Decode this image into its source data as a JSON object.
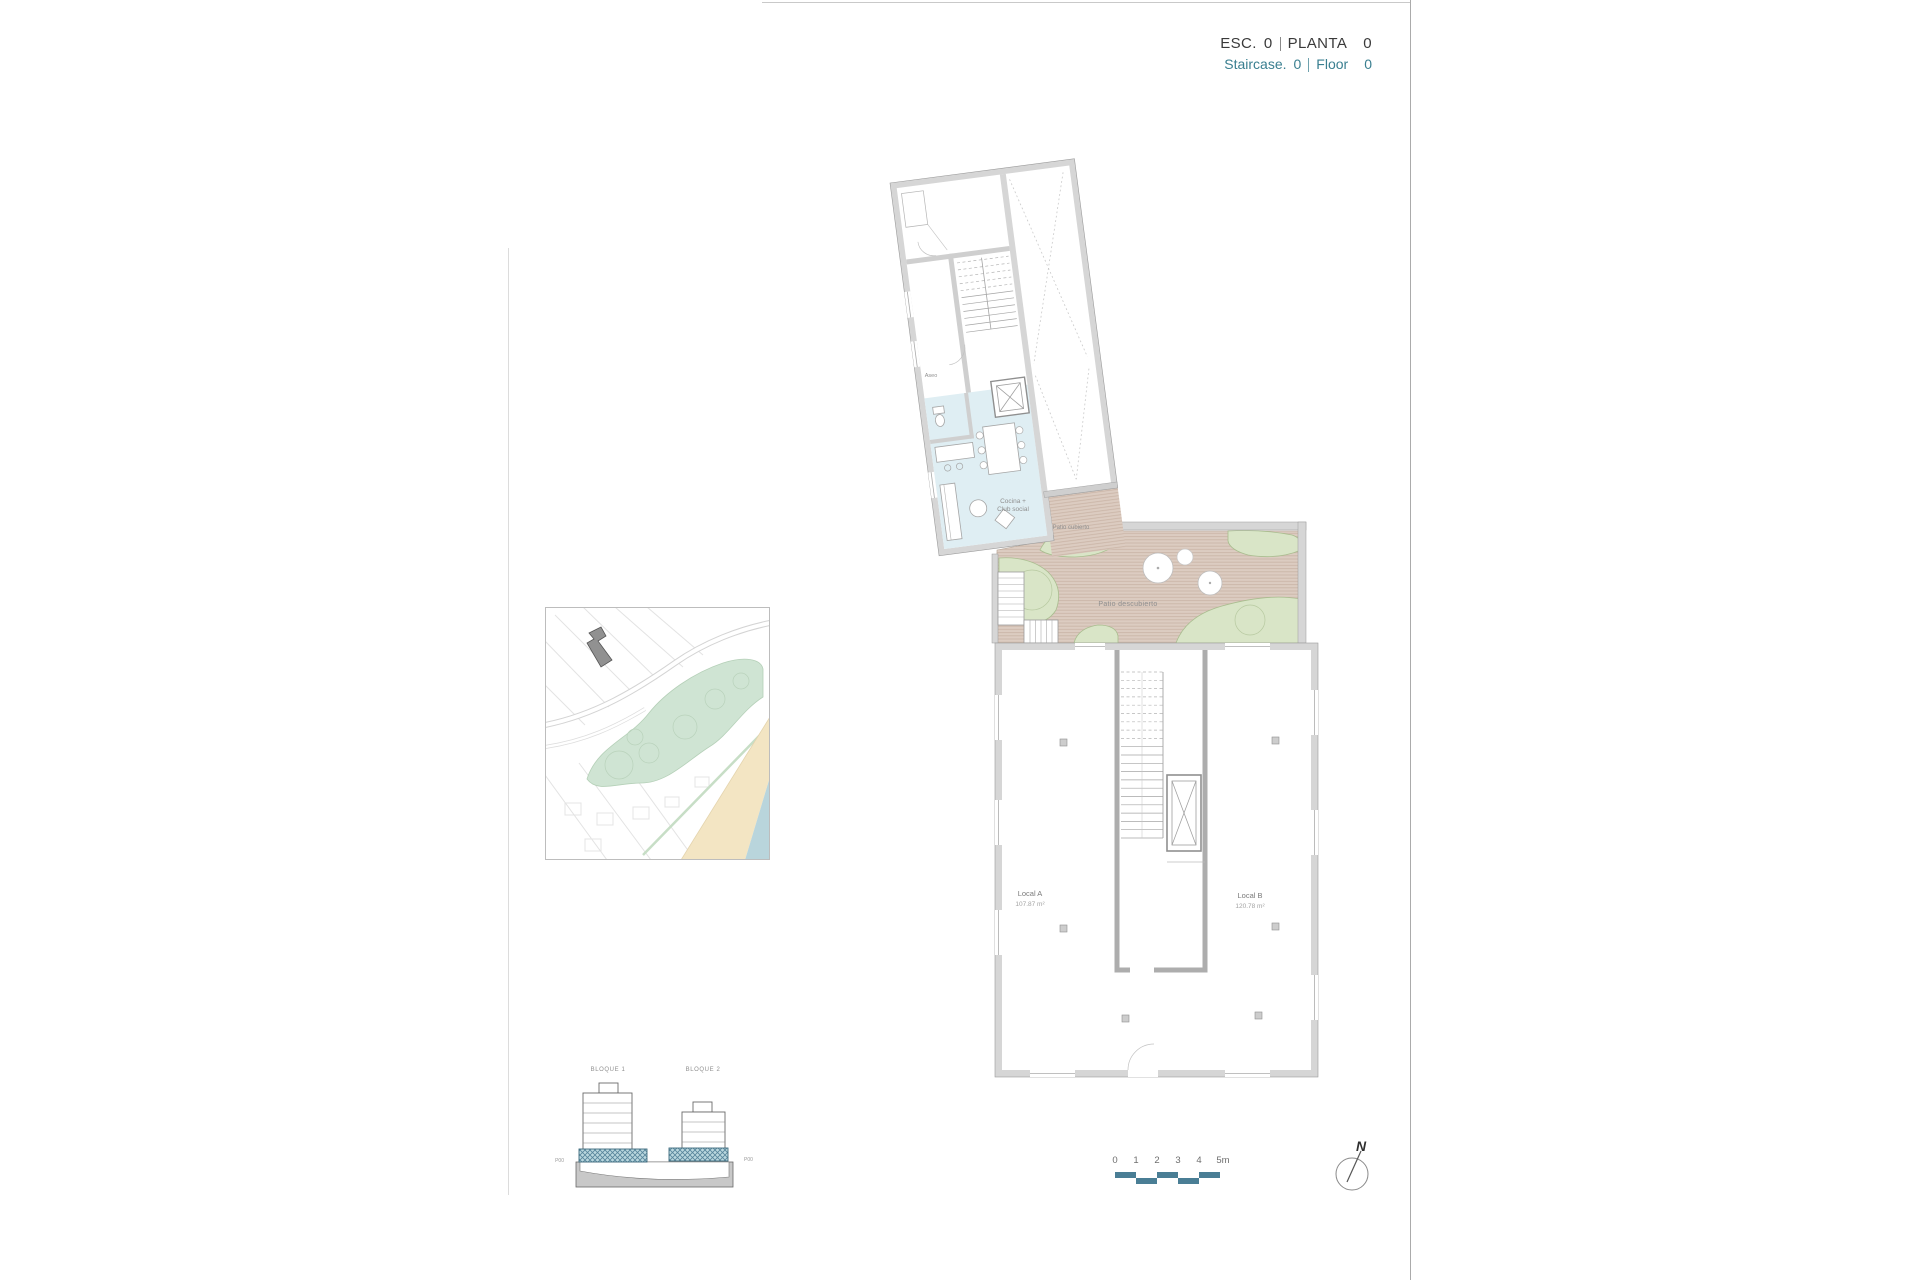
{
  "header": {
    "line1": {
      "label1": "ESC.",
      "value1": "0",
      "label2": "PLANTA",
      "value2": "0"
    },
    "line2": {
      "label1": "Staircase.",
      "value1": "0",
      "label2": "Floor",
      "value2": "0"
    }
  },
  "plan": {
    "aseo": "Aseo",
    "cocina_line1": "Cocina +",
    "cocina_line2": "Club social",
    "patio_cubierto": "Patio cubierto",
    "patio_descubierto": "Patio descubierto",
    "local_a_name": "Local A",
    "local_a_area": "107.87 m²",
    "local_b_name": "Local B",
    "local_b_area": "120.78 m²"
  },
  "elevation": {
    "bloque1": "BLOQUE 1",
    "bloque2": "BLOQUE 2",
    "p00_left": "P00",
    "p00_right": "P00"
  },
  "scale_bar": {
    "ticks": [
      "0",
      "1",
      "2",
      "3",
      "4",
      "5m"
    ]
  },
  "compass": {
    "north": "N"
  },
  "colors": {
    "accent_teal": "#3a7f90",
    "scalebar_teal": "#4a7e95",
    "wall_gray": "#d6d6d6",
    "floor_blue": "#dfeef3",
    "patio_tan": "#dcccc1",
    "green": "#d9e5c7",
    "map_green": "#cfe4d3",
    "sand": "#f3e5c3",
    "sea": "#b9d5dc"
  }
}
